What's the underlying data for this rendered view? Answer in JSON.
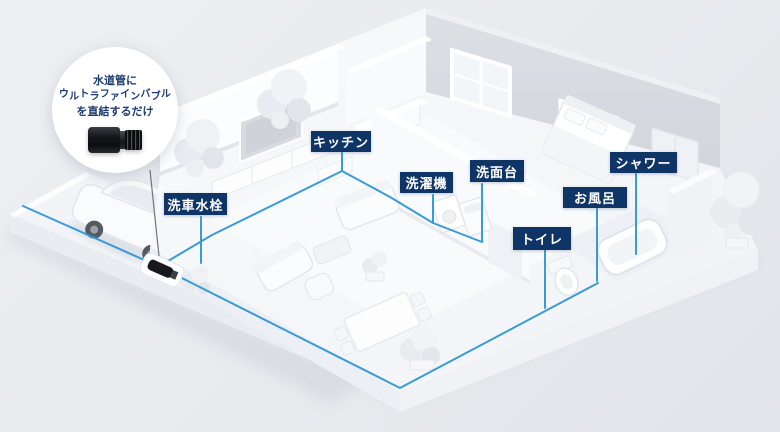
{
  "callout": {
    "line1": "水道管に",
    "line2": "ウルトラファインバブル",
    "line3": "を直結するだけ",
    "product_icon": "ultra-fine-bubble-adapter"
  },
  "labels": [
    {
      "id": "car-wash-faucet",
      "text": "洗車水栓"
    },
    {
      "id": "kitchen",
      "text": "キッチン"
    },
    {
      "id": "washing-machine",
      "text": "洗濯機"
    },
    {
      "id": "washbasin",
      "text": "洗面台"
    },
    {
      "id": "toilet",
      "text": "トイレ"
    },
    {
      "id": "bath",
      "text": "お風呂"
    },
    {
      "id": "shower",
      "text": "シャワー"
    }
  ],
  "icons": {
    "device_on_pipe": "bubble-device",
    "pipe_network": "water-pipe-lines"
  },
  "colors": {
    "label_bg": "#0f3566",
    "label_text": "#ffffff",
    "callout_text": "#1e3c6f",
    "pipe_blue": "#2f97d5",
    "bg": "#e8ebee"
  }
}
